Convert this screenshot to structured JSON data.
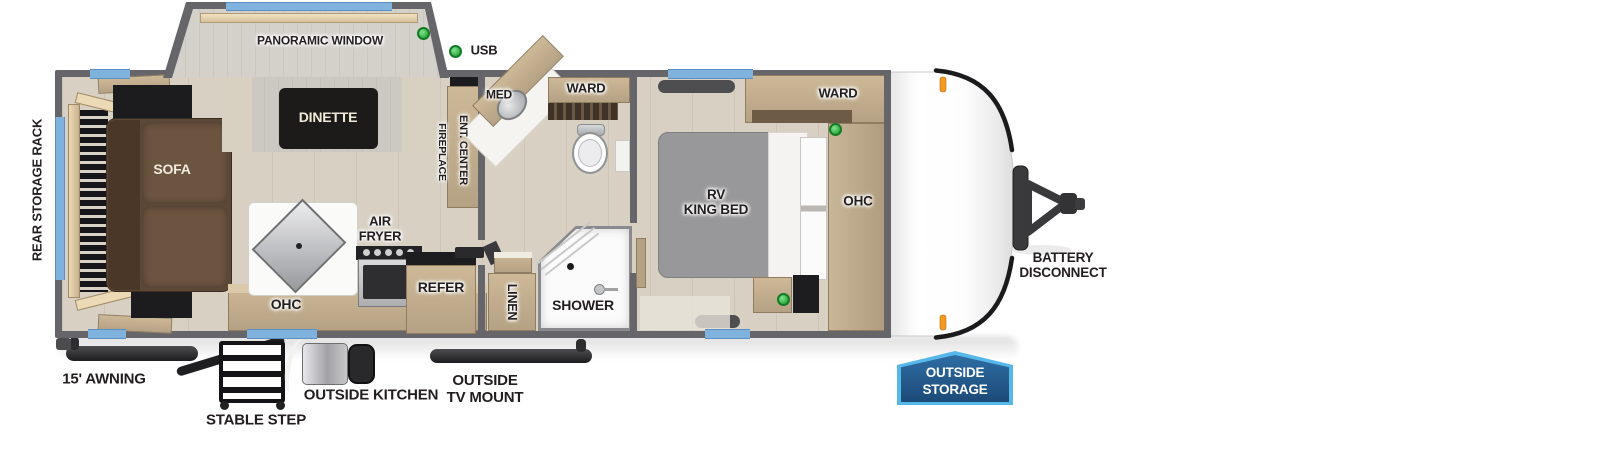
{
  "colors": {
    "wall": "#66666a",
    "floor": "#d8d0c3",
    "window_blue": "#7fb3de",
    "usb_green": "#3cb54a",
    "marker_orange": "#f49a20",
    "badge_dark": "#1c4a77",
    "badge_light": "#2e6da4",
    "badge_border": "#56b8e9",
    "wood": "#c3ad90",
    "wood_dark": "#8c7b64",
    "sofa": "#5c4836",
    "bed_gray": "#98989a"
  },
  "slide_out": {
    "panoramic_window": "PANORAMIC WINDOW",
    "dinette": "DINETTE"
  },
  "legend": {
    "usb": "USB"
  },
  "living": {
    "sofa": "SOFA",
    "rear_storage_rack": "REAR STORAGE RACK",
    "ent_center": "ENT. CENTER",
    "fireplace": "FIREPLACE"
  },
  "kitchen": {
    "air_fryer": "AIR\nFRYER",
    "ohc": "OHC",
    "refer": "REFER"
  },
  "bath": {
    "med": "MED",
    "ward": "WARD",
    "linen": "LINEN",
    "shower": "SHOWER"
  },
  "bedroom": {
    "ward": "WARD",
    "bed": "RV\nKING BED",
    "ohc": "OHC"
  },
  "exterior": {
    "awning": "15' AWNING",
    "stable_step": "STABLE STEP",
    "outside_kitchen": "OUTSIDE KITCHEN",
    "outside_tv_mount": "OUTSIDE\nTV MOUNT",
    "battery_disconnect": "BATTERY\nDISCONNECT",
    "outside_storage": "OUTSIDE\nSTORAGE"
  }
}
